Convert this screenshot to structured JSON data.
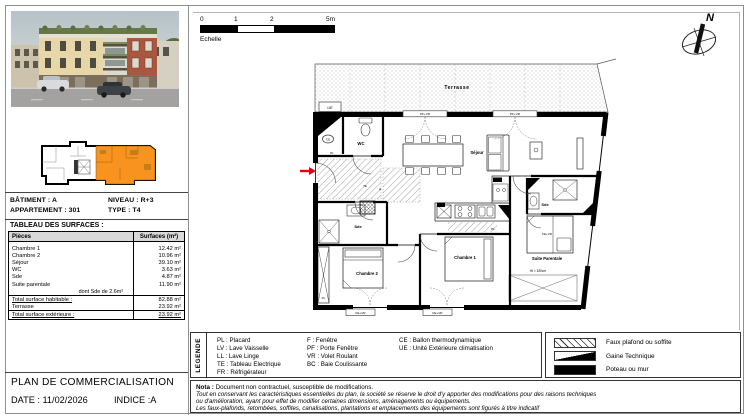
{
  "title_block": {
    "title": "PLAN DE COMMERCIALISATION",
    "date": "DATE : 11/02/2026",
    "indice": "INDICE :A"
  },
  "info": {
    "batiment": "BÂTIMENT : A",
    "niveau": "NIVEAU : R+3",
    "appartement": "APPARTEMENT : 301",
    "type": "TYPE : T4",
    "surfaces_title": "TABLEAU DES SURFACES :"
  },
  "surfaces": {
    "col_piece": "Pièces",
    "col_surface": "Surfaces (m²)",
    "rows": [
      {
        "piece": "Chambre 1",
        "surface": "12.42 m²"
      },
      {
        "piece": "Chambre 2",
        "surface": "10.96 m²"
      },
      {
        "piece": "Séjour",
        "surface": "39.10 m²"
      },
      {
        "piece": "WC",
        "surface": "3.63 m²"
      },
      {
        "piece": "Sde",
        "surface": "4.87 m²"
      },
      {
        "piece": "Suite parentale",
        "surface": "11.90 m²"
      }
    ],
    "dont": "dont Sde de 2.6m²",
    "total_hab_label": "Total surface habitable :",
    "total_hab": "82.88 m²",
    "terrasse_label": "Terrasse",
    "terrasse": "23.92 m²",
    "total_ext_label": "Total surface extérieure :",
    "total_ext": "23.92 m²"
  },
  "scalebar": {
    "t0": "0",
    "t1": "1",
    "t2": "2",
    "t5": "5m",
    "label": "Echelle"
  },
  "north": {
    "label": "N"
  },
  "plan": {
    "labels": {
      "terrasse": "Terrasse",
      "ue": "UE",
      "pf_vr": "PF+VR",
      "fe_vr": "FE+VR",
      "wc": "WC",
      "ce": "CE",
      "pl": "PL",
      "te": "TE",
      "pf": "pf",
      "fr": "FR",
      "lv": "LV",
      "sejour": "Séjour",
      "sde": "Sde",
      "chambre1": "Chambre 1",
      "chambre2": "Chambre 2",
      "suite_parentale": "Suite Parentale",
      "ht": "Ht < 180cm"
    }
  },
  "legend": {
    "title": "LEGENDE",
    "col1": [
      "PL : Placard",
      "LV : Lave Vaisselle",
      "LL : Lave Linge",
      "TE : Tableau Electrique",
      "FR : Réfrigérateur"
    ],
    "col2": [
      "F : Fenêtre",
      "PF : Porte Fenêtre",
      "VR : Volet Roulant",
      "BC : Baie Coulissante"
    ],
    "col3": [
      "CE : Ballon thermodynamique",
      "UE : Unité Extérieure climatisation"
    ]
  },
  "symbols": {
    "s1": "Faux plafond ou soffite",
    "s2": "Gaine Technique",
    "s3": "Poteau ou mur"
  },
  "nota": {
    "bold": "Nota :",
    "l1": " Document non contractuel, susceptible de modifications.",
    "l2": "Tout en conservant les caractéristiques essentielles du plan, la société se réserve le droit d'y apporter des modifications pour des raisons techniques",
    "l3": "ou d'amélioration, ayant pour effet de modifier certaines dimensions, aménagements ou équipements.",
    "l4": "Les faux-plafonds, retombées, soffites, canalisations, plantations et emplacements des équipements sont figurés à titre indicatif"
  },
  "colors": {
    "highlight": "#F7931E",
    "arrow": "#E8000D"
  }
}
